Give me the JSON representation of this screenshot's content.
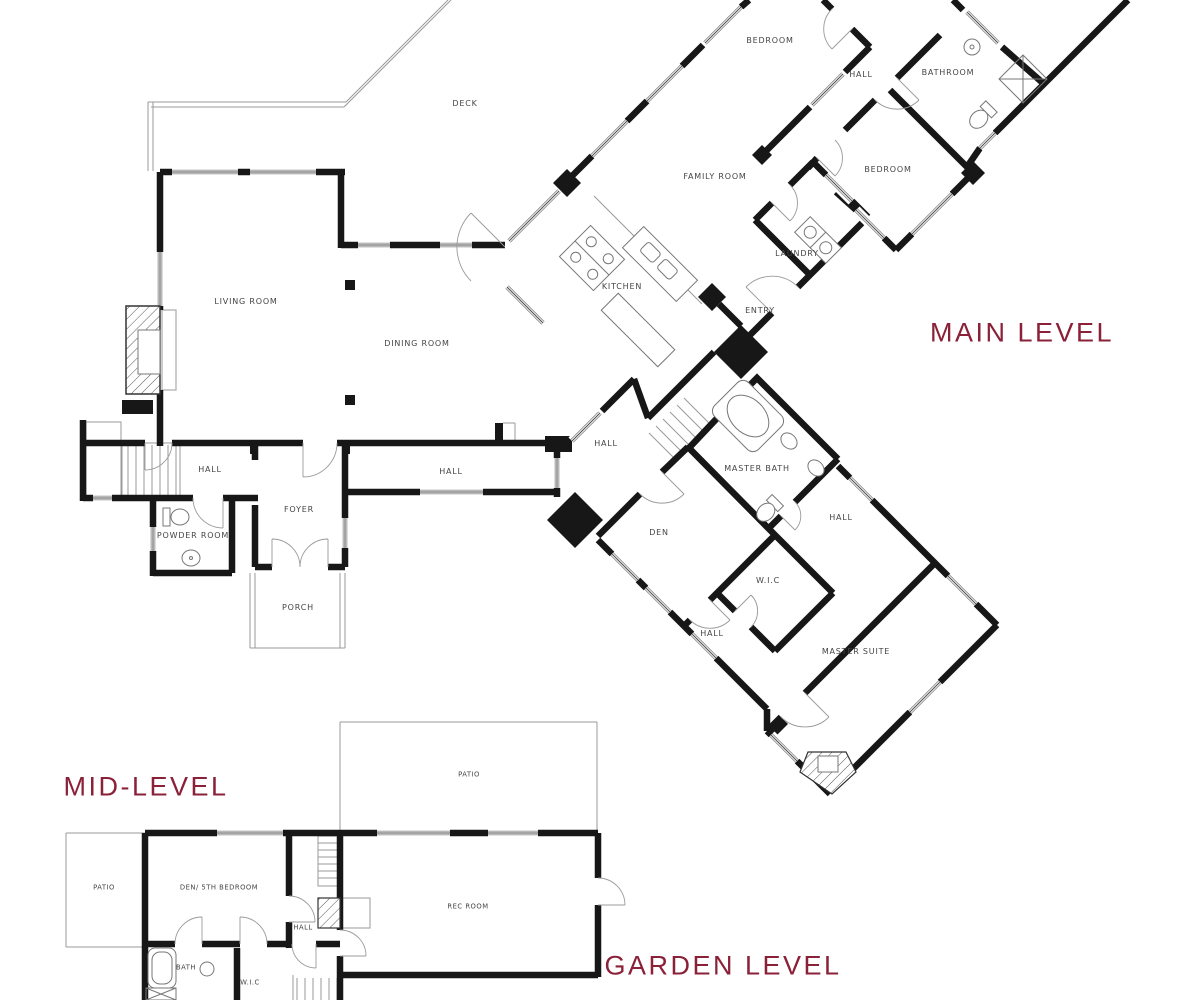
{
  "titles": [
    {
      "text": "MAIN LEVEL"
    },
    {
      "text": "MID-LEVEL"
    },
    {
      "text": "GARDEN LEVEL"
    }
  ],
  "rooms": [
    {
      "text": "BEDROOM"
    },
    {
      "text": "HALL"
    },
    {
      "text": "BATHROOM"
    },
    {
      "text": "BEDROOM"
    },
    {
      "text": "DECK"
    },
    {
      "text": "FAMILY ROOM"
    },
    {
      "text": "LAUNDRY"
    },
    {
      "text": "KITCHEN"
    },
    {
      "text": "ENTRY"
    },
    {
      "text": "LIVING ROOM"
    },
    {
      "text": "DINING ROOM"
    },
    {
      "text": "HALL"
    },
    {
      "text": "HALL"
    },
    {
      "text": "HALL"
    },
    {
      "text": "MASTER BATH"
    },
    {
      "text": "FOYER"
    },
    {
      "text": "POWDER ROOM"
    },
    {
      "text": "HALL"
    },
    {
      "text": "DEN"
    },
    {
      "text": "W.I.C"
    },
    {
      "text": "PORCH"
    },
    {
      "text": "HALL"
    },
    {
      "text": "MASTER SUITE"
    },
    {
      "text": "PATIO"
    },
    {
      "text": "PATIO"
    },
    {
      "text": "DEN/ 5TH BEDROOM"
    },
    {
      "text": "REC ROOM"
    },
    {
      "text": "HALL"
    },
    {
      "text": "BATH"
    },
    {
      "text": "W.I.C"
    }
  ],
  "colors": {
    "accent": "#8a2138",
    "walls": "#171717",
    "label": "#454545"
  }
}
